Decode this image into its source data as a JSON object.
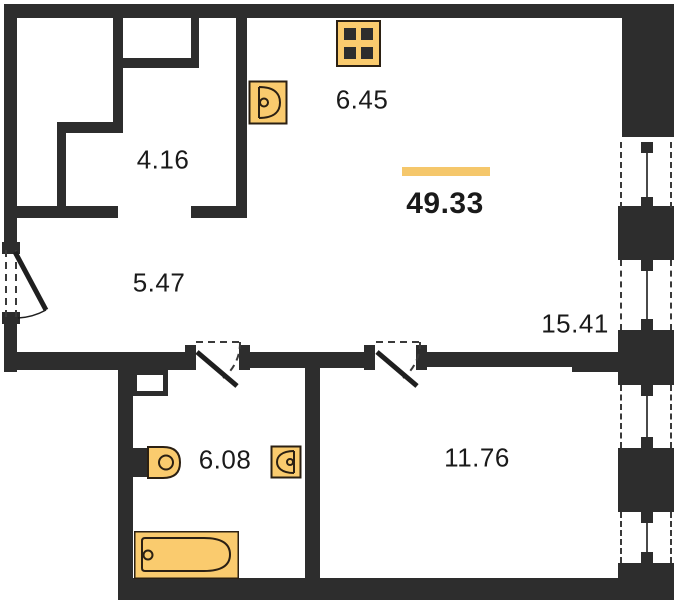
{
  "plan": {
    "title": "apartment-floor-plan",
    "total": {
      "area": "49.33"
    },
    "rooms": {
      "wardrobe": {
        "area": "4.16"
      },
      "kitchen": {
        "area": "6.45"
      },
      "hallway": {
        "area": "5.47"
      },
      "living": {
        "area": "15.41"
      },
      "bathroom": {
        "area": "6.08"
      },
      "bedroom": {
        "area": "11.76"
      }
    },
    "fixtures": [
      "stove",
      "kitchen-sink",
      "toilet",
      "washbasin",
      "bathtub"
    ],
    "colors": {
      "wall": "#2D2D2D",
      "fixture_fill": "#FACB6E",
      "fixture_stroke": "#2B2013",
      "accent_bar": "#F5C76B",
      "text": "#1A1A1A"
    }
  }
}
